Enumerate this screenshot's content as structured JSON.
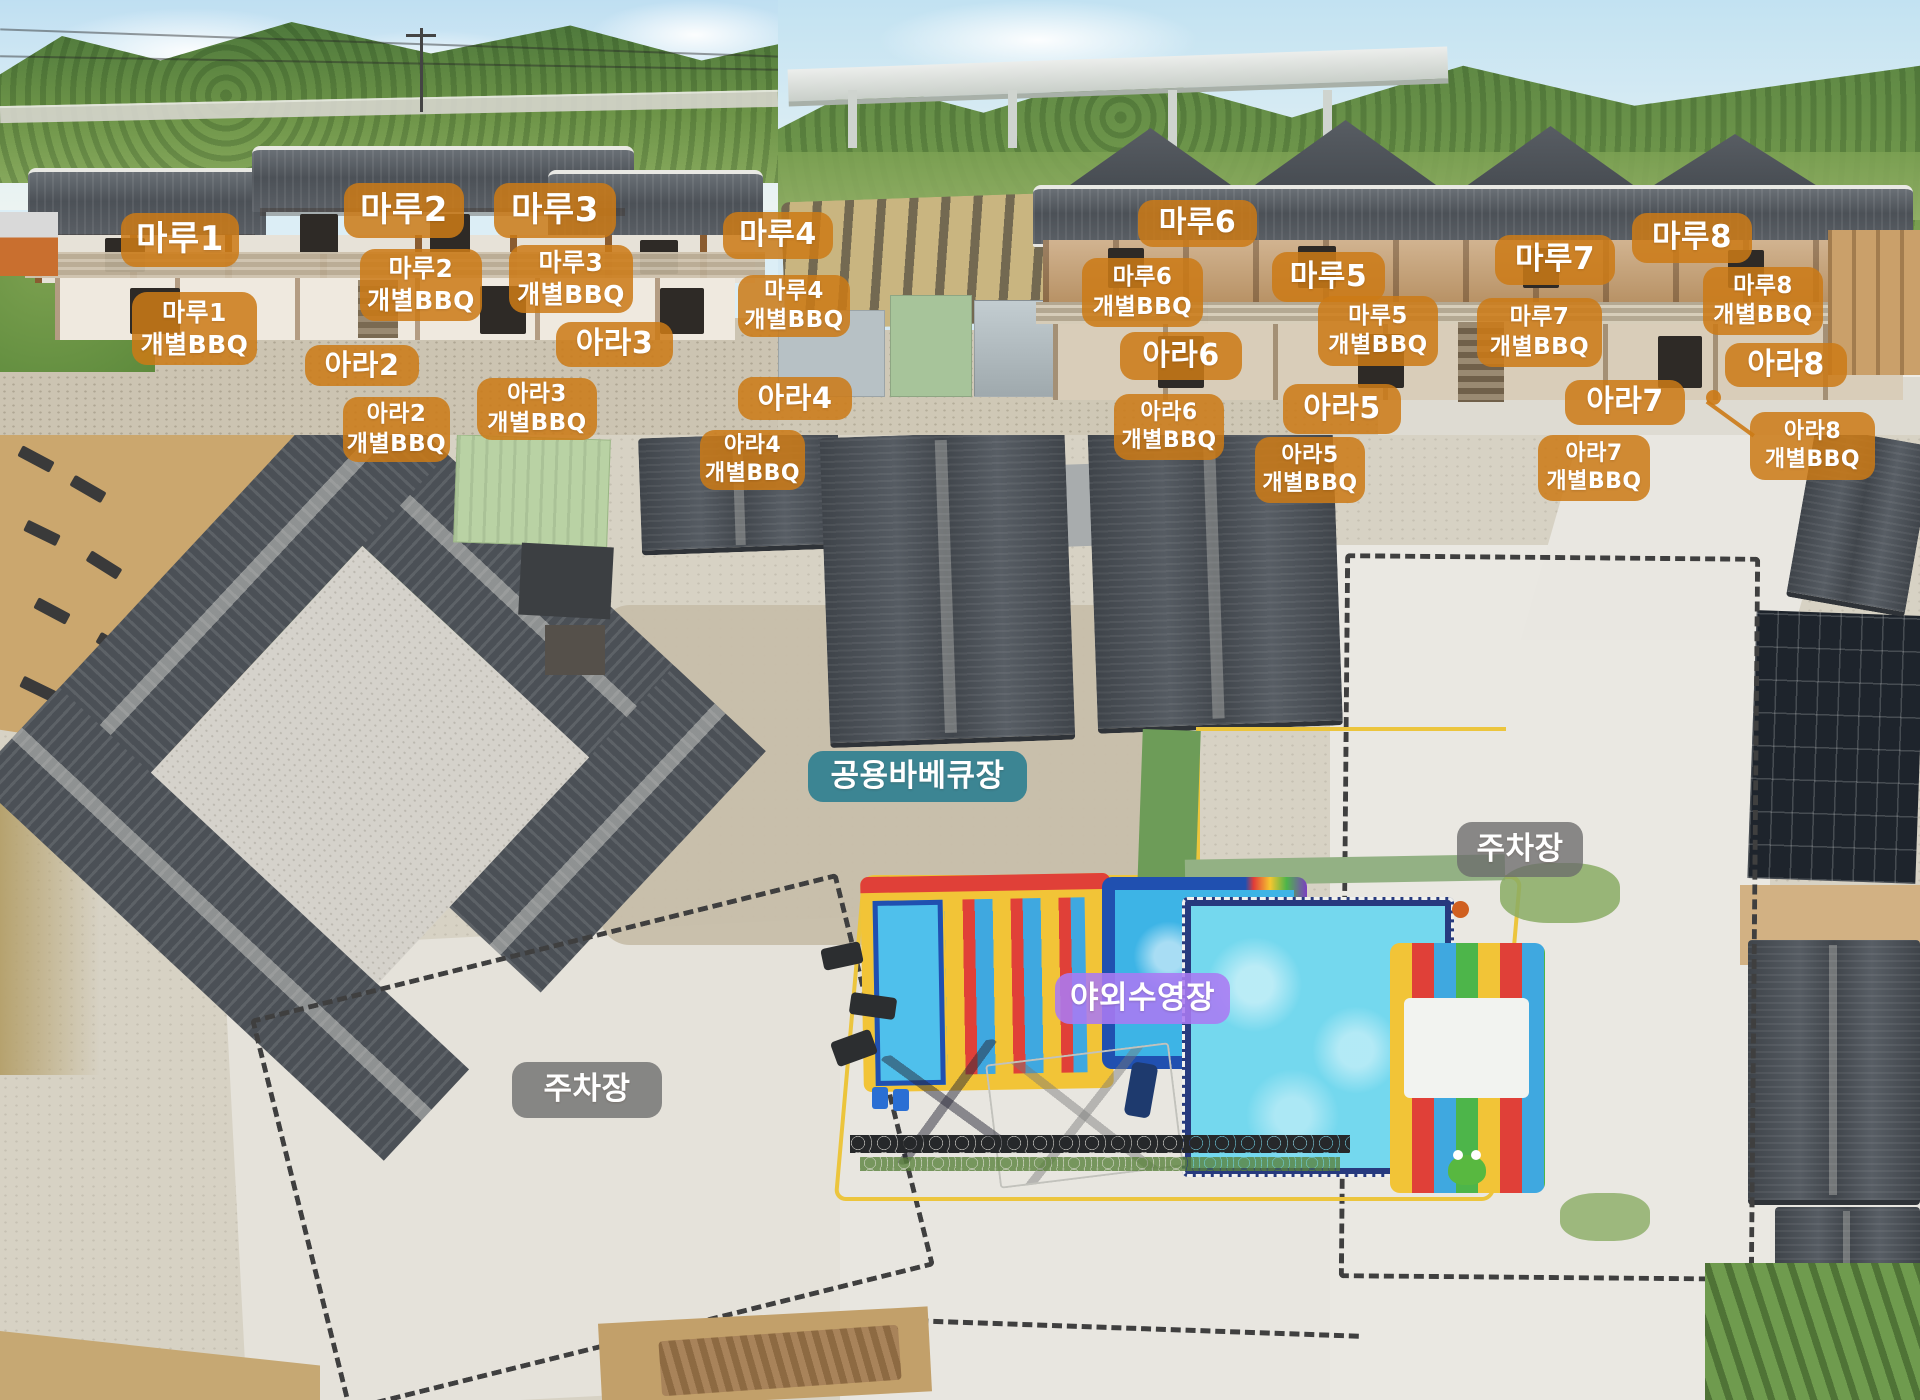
{
  "colors": {
    "room": "rgba(204,122,22,0.86)",
    "bbq": "rgba(204,122,22,0.86)",
    "shared_bbq": "rgba(50,128,145,0.93)",
    "parking": "rgba(108,108,108,0.78)",
    "pool": "rgba(170,122,242,0.88)"
  },
  "photos": {
    "top_left": {
      "labels": [
        {
          "id": "maru1",
          "type": "room",
          "text": "마루1",
          "x": 121,
          "y": 213,
          "w": 118,
          "h": 54,
          "fs": 34
        },
        {
          "id": "maru2",
          "type": "room",
          "text": "마루2",
          "x": 344,
          "y": 183,
          "w": 120,
          "h": 55,
          "fs": 34
        },
        {
          "id": "maru3",
          "type": "room",
          "text": "마루3",
          "x": 494,
          "y": 183,
          "w": 122,
          "h": 55,
          "fs": 34
        },
        {
          "id": "maru4",
          "type": "room",
          "text": "마루4",
          "x": 723,
          "y": 212,
          "w": 110,
          "h": 47,
          "fs": 30
        },
        {
          "id": "maru1-bbq",
          "type": "bbq",
          "text": "마루1\n개별BBQ",
          "x": 132,
          "y": 292,
          "w": 125,
          "h": 73,
          "fs": 25
        },
        {
          "id": "maru2-bbq",
          "type": "bbq",
          "text": "마루2\n개별BBQ",
          "x": 360,
          "y": 249,
          "w": 122,
          "h": 72,
          "fs": 25
        },
        {
          "id": "maru3-bbq",
          "type": "bbq",
          "text": "마루3\n개별BBQ",
          "x": 509,
          "y": 245,
          "w": 124,
          "h": 68,
          "fs": 25
        },
        {
          "id": "maru4-bbq",
          "type": "bbq",
          "text": "마루4\n개별BBQ",
          "x": 738,
          "y": 275,
          "w": 112,
          "h": 62,
          "fs": 23
        },
        {
          "id": "ara2",
          "type": "room",
          "text": "아라2",
          "x": 305,
          "y": 345,
          "w": 114,
          "h": 41,
          "fs": 29
        },
        {
          "id": "ara3",
          "type": "room",
          "text": "아라3",
          "x": 556,
          "y": 322,
          "w": 117,
          "h": 45,
          "fs": 30
        },
        {
          "id": "ara4",
          "type": "room",
          "text": "아라4",
          "x": 738,
          "y": 377,
          "w": 114,
          "h": 43,
          "fs": 29
        },
        {
          "id": "ara2-bbq",
          "type": "bbq",
          "text": "아라2\n개별BBQ",
          "x": 343,
          "y": 397,
          "w": 107,
          "h": 65,
          "fs": 23
        },
        {
          "id": "ara3-bbq",
          "type": "bbq",
          "text": "아라3\n개별BBQ",
          "x": 477,
          "y": 378,
          "w": 120,
          "h": 62,
          "fs": 23
        },
        {
          "id": "ara4-bbq",
          "type": "bbq",
          "text": "아라4\n개별BBQ",
          "x": 700,
          "y": 430,
          "w": 105,
          "h": 60,
          "fs": 22
        }
      ]
    },
    "top_right": {
      "labels": [
        {
          "id": "maru6",
          "type": "room",
          "text": "마루6",
          "x": 360,
          "y": 200,
          "w": 119,
          "h": 47,
          "fs": 30
        },
        {
          "id": "maru5",
          "type": "room",
          "text": "마루5",
          "x": 494,
          "y": 252,
          "w": 113,
          "h": 50,
          "fs": 30
        },
        {
          "id": "maru7",
          "type": "room",
          "text": "마루7",
          "x": 717,
          "y": 235,
          "w": 120,
          "h": 50,
          "fs": 31
        },
        {
          "id": "maru8",
          "type": "room",
          "text": "마루8",
          "x": 854,
          "y": 213,
          "w": 120,
          "h": 50,
          "fs": 31
        },
        {
          "id": "maru6-bbq",
          "type": "bbq",
          "text": "마루6\n개별BBQ",
          "x": 304,
          "y": 258,
          "w": 121,
          "h": 69,
          "fs": 23
        },
        {
          "id": "maru5-bbq",
          "type": "bbq",
          "text": "마루5\n개별BBQ",
          "x": 540,
          "y": 296,
          "w": 120,
          "h": 70,
          "fs": 23
        },
        {
          "id": "maru7-bbq",
          "type": "bbq",
          "text": "마루7\n개별BBQ",
          "x": 699,
          "y": 298,
          "w": 125,
          "h": 69,
          "fs": 23
        },
        {
          "id": "maru8-bbq",
          "type": "bbq",
          "text": "마루8\n개별BBQ",
          "x": 925,
          "y": 267,
          "w": 120,
          "h": 68,
          "fs": 23
        },
        {
          "id": "ara6",
          "type": "room",
          "text": "아라6",
          "x": 342,
          "y": 332,
          "w": 122,
          "h": 48,
          "fs": 30
        },
        {
          "id": "ara5",
          "type": "room",
          "text": "아라5",
          "x": 505,
          "y": 384,
          "w": 118,
          "h": 50,
          "fs": 30
        },
        {
          "id": "ara7",
          "type": "room",
          "text": "아라7",
          "x": 787,
          "y": 380,
          "w": 120,
          "h": 45,
          "fs": 30
        },
        {
          "id": "ara8",
          "type": "room",
          "text": "아라8",
          "x": 947,
          "y": 343,
          "w": 122,
          "h": 44,
          "fs": 30
        },
        {
          "id": "ara6-bbq",
          "type": "bbq",
          "text": "아라6\n개별BBQ",
          "x": 336,
          "y": 394,
          "w": 110,
          "h": 66,
          "fs": 22
        },
        {
          "id": "ara5-bbq",
          "type": "bbq",
          "text": "아라5\n개별BBQ",
          "x": 477,
          "y": 437,
          "w": 110,
          "h": 66,
          "fs": 22
        },
        {
          "id": "ara7-bbq",
          "type": "bbq",
          "text": "아라7\n개별BBQ",
          "x": 760,
          "y": 435,
          "w": 112,
          "h": 66,
          "fs": 22
        },
        {
          "id": "ara8-bbq",
          "type": "bbq",
          "text": "아라8\n개별BBQ",
          "x": 972,
          "y": 412,
          "w": 125,
          "h": 68,
          "fs": 22
        }
      ]
    },
    "aerial": {
      "labels": [
        {
          "id": "shared-bbq",
          "type": "shared_bbq",
          "text": "공용바베큐장",
          "x": 808,
          "y": 316,
          "w": 219,
          "h": 51,
          "fs": 31
        },
        {
          "id": "parking-right",
          "type": "parking",
          "text": "주차장",
          "x": 1457,
          "y": 387,
          "w": 126,
          "h": 55,
          "fs": 31
        },
        {
          "id": "pool",
          "type": "pool",
          "text": "야외수영장",
          "x": 1055,
          "y": 538,
          "w": 175,
          "h": 51,
          "fs": 31
        },
        {
          "id": "parking-left",
          "type": "parking",
          "text": "주차장",
          "x": 512,
          "y": 627,
          "w": 150,
          "h": 56,
          "fs": 31
        }
      ]
    }
  }
}
